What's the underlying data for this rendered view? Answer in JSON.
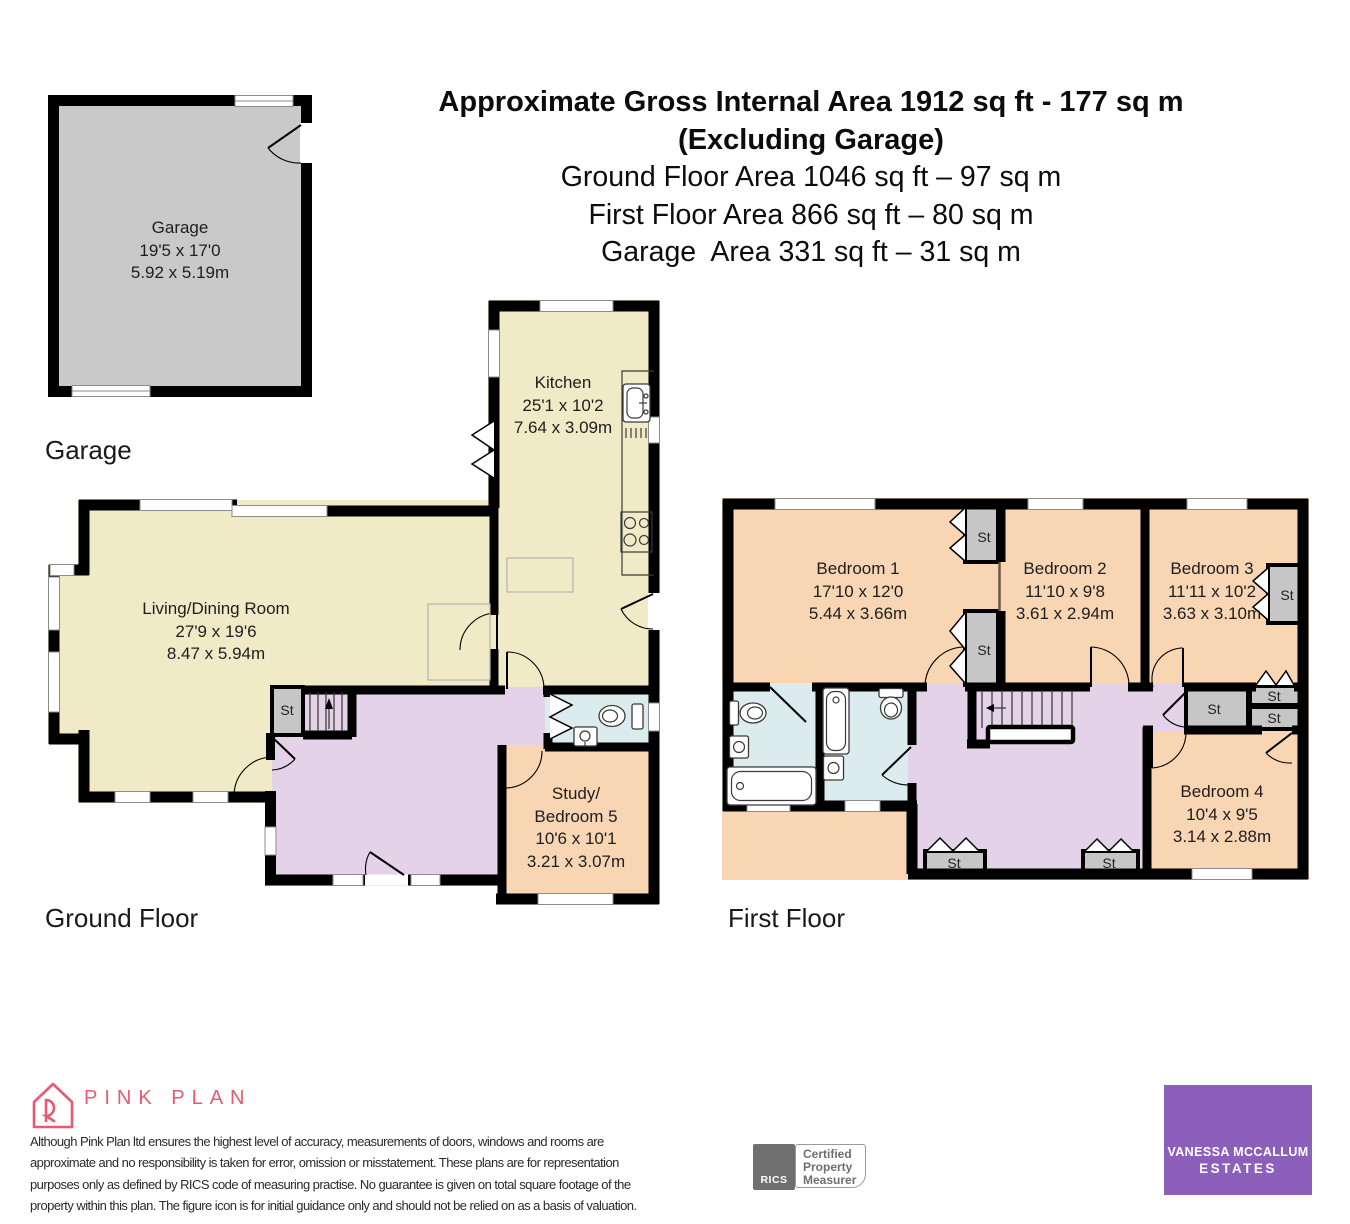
{
  "header": {
    "line1": "Approximate Gross Internal Area 1912 sq ft - 177 sq m",
    "line2": "(Excluding Garage)",
    "line3": "Ground Floor Area 1046 sq ft – 97 sq m",
    "line4": "First Floor Area 866 sq ft – 80 sq m",
    "line5": "Garage  Area 331 sq ft – 31 sq m"
  },
  "floor_labels": {
    "garage": "Garage",
    "ground": "Ground Floor",
    "first": "First Floor"
  },
  "rooms": {
    "garage": {
      "name": "Garage",
      "imperial": "19'5 x 17'0",
      "metric": "5.92 x 5.19m"
    },
    "kitchen": {
      "name": "Kitchen",
      "imperial": "25'1 x 10'2",
      "metric": "7.64 x 3.09m"
    },
    "living_dining": {
      "name": "Living/Dining Room",
      "imperial": "27'9 x 19'6",
      "metric": "8.47 x 5.94m"
    },
    "study_bedroom5": {
      "name_line1": "Study/",
      "name_line2": "Bedroom 5",
      "imperial": "10'6 x 10'1",
      "metric": "3.21 x 3.07m"
    },
    "bedroom1": {
      "name": "Bedroom 1",
      "imperial": "17'10 x 12'0",
      "metric": "5.44 x 3.66m"
    },
    "bedroom2": {
      "name": "Bedroom 2",
      "imperial": "11'10 x 9'8",
      "metric": "3.61 x 2.94m"
    },
    "bedroom3": {
      "name": "Bedroom 3",
      "imperial": "11'11 x 10'2",
      "metric": "3.63 x 3.10m"
    },
    "bedroom4": {
      "name": "Bedroom 4",
      "imperial": "10'4 x 9'5",
      "metric": "3.14 x 2.88m"
    }
  },
  "storage_label": "St",
  "footer": {
    "brand": "PINK PLAN",
    "disclaimer_line1": "Although Pink Plan ltd ensures the highest level of accuracy, measurements of doors, windows and rooms are",
    "disclaimer_line2": "approximate and no responsibility is taken for error, omission or misstatement. These plans are for representation",
    "disclaimer_line3": "purposes only as defined by RICS code of measuring practise. No guarantee is given on total square footage of the",
    "disclaimer_line4": "property within this plan. The figure icon is for initial guidance only and should not be relied on as a basis of valuation.",
    "rics_name": "RICS",
    "rics_cert_line1": "Certified",
    "rics_cert_line2": "Property",
    "rics_cert_line3": "Measurer",
    "agency_name_line1": "VANESSA MCCALLUM",
    "agency_name_line2": "ESTATES"
  },
  "colors": {
    "wall": "#000000",
    "room_tan": "#f0ebc6",
    "room_peach": "#f8d5b3",
    "room_lavender": "#e3d2e8",
    "room_blue": "#dcebee",
    "room_gray": "#c9c9c9",
    "storage_gray": "#c6c6c6",
    "brand_pink": "#e85a72",
    "agency_purple": "#8c60ba",
    "rics_gray": "#6f6f6f"
  }
}
